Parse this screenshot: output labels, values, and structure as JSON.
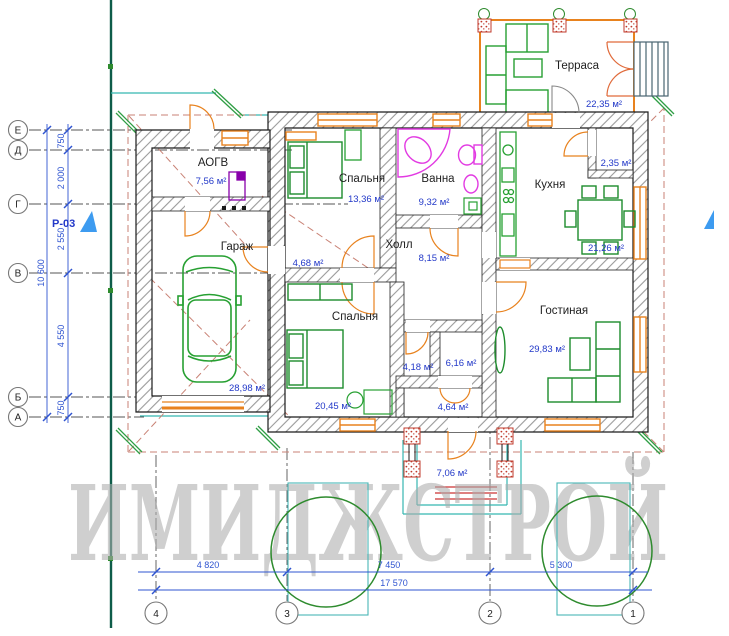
{
  "watermark": "ИМИДЖСТРОЙ",
  "section_marker": "Р-03",
  "rooms": {
    "terrace": {
      "name": "Терраса",
      "area": "22,35 м²"
    },
    "aogv": {
      "name": "АОГВ",
      "area": "7,56 м²"
    },
    "garage": {
      "name": "Гараж",
      "area": "28,98 м²"
    },
    "bedroom1": {
      "name": "Спальня",
      "area": "13,36 м²"
    },
    "bath": {
      "name": "Ванна",
      "area": "9,32 м²"
    },
    "kitchen": {
      "name": "Кухня",
      "area": "21,26 м²"
    },
    "pantry": {
      "area": "2,35 м²"
    },
    "hall": {
      "name": "Холл",
      "area": "8,15 м²"
    },
    "corridor": {
      "area": "4,68 м²"
    },
    "bedroom2": {
      "name": "Спальня",
      "area": "20,45 м²"
    },
    "room418": {
      "area": "4,18 м²"
    },
    "room616": {
      "area": "6,16 м²"
    },
    "vestibule": {
      "area": "4,64 м²"
    },
    "porch": {
      "area": "7,06 м²"
    },
    "living": {
      "name": "Гостиная",
      "area": "29,83 м²"
    }
  },
  "grid": {
    "rows": [
      "Е",
      "Д",
      "Г",
      "В",
      "Б",
      "А"
    ],
    "cols": [
      "4",
      "3",
      "2",
      "1"
    ]
  },
  "dimensions": {
    "vertical": {
      "segments": [
        "750",
        "2 000",
        "2 550",
        "4 550",
        "750"
      ],
      "total": "10 600"
    },
    "horizontal": {
      "segments": [
        "4 820",
        "7 450",
        "5 300"
      ],
      "total": "17 570"
    }
  },
  "colors": {
    "wall_hatch": "#9a9a9a",
    "outline": "#1a1a1a",
    "window_orange": "#e8821e",
    "furniture_green": "#27a032",
    "fixture_magenta": "#e23ae2",
    "dimension_blue": "#2f54d0",
    "area_blue": "#2238c8",
    "grid_gray": "#555555",
    "roof_dash": "#c98275",
    "eaves_teal": "#35b6b0",
    "boundary_green": "#0e5c49",
    "watermark_gray": "#ababab",
    "marker_blue": "#3d9bf0",
    "column_red": "#c03a2b",
    "tree_green": "#2e8b2e"
  }
}
